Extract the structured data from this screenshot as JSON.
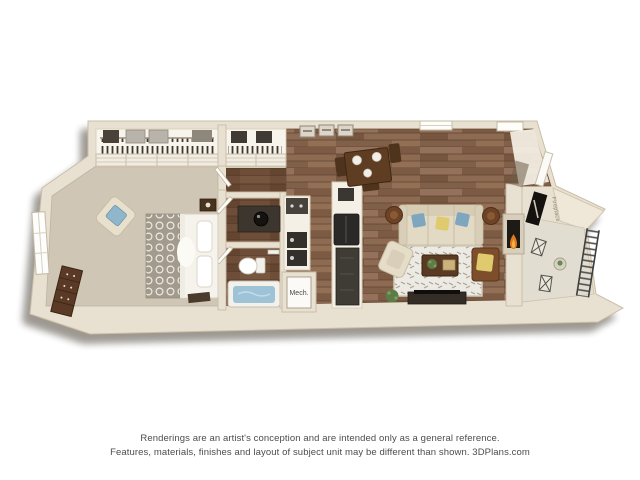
{
  "floorplan": {
    "kind": "3d-rendered one-bedroom apartment floor plan",
    "labels": {
      "mech": "Mech.",
      "fireplace": "Fireplace"
    },
    "rooms": [
      "bedroom",
      "bedroom-closet",
      "hall-closet",
      "vanity",
      "bathroom",
      "mechanical-closet",
      "kitchen",
      "dining-area",
      "living-room",
      "balcony",
      "entry"
    ],
    "colors": {
      "wall_cream": "#e8e0d0",
      "wall_edge": "#cbbea8",
      "carpet": "#cfc6b5",
      "hardwood": "#8a6950",
      "bath_wood": "#6e4e38",
      "tub_water": "#9fc3d6",
      "sofa": "#e3dac6",
      "accent_blue": "#7fa6bf",
      "accent_yellow": "#e0ca6e",
      "fire": "#e07a1f",
      "rug": "#eceae2"
    }
  },
  "disclaimer": {
    "line1": "Renderings are an artist's conception and are intended only as a general reference.",
    "line2": "Features, materials, finishes and layout of subject unit may be different than shown. 3DPlans.com"
  }
}
